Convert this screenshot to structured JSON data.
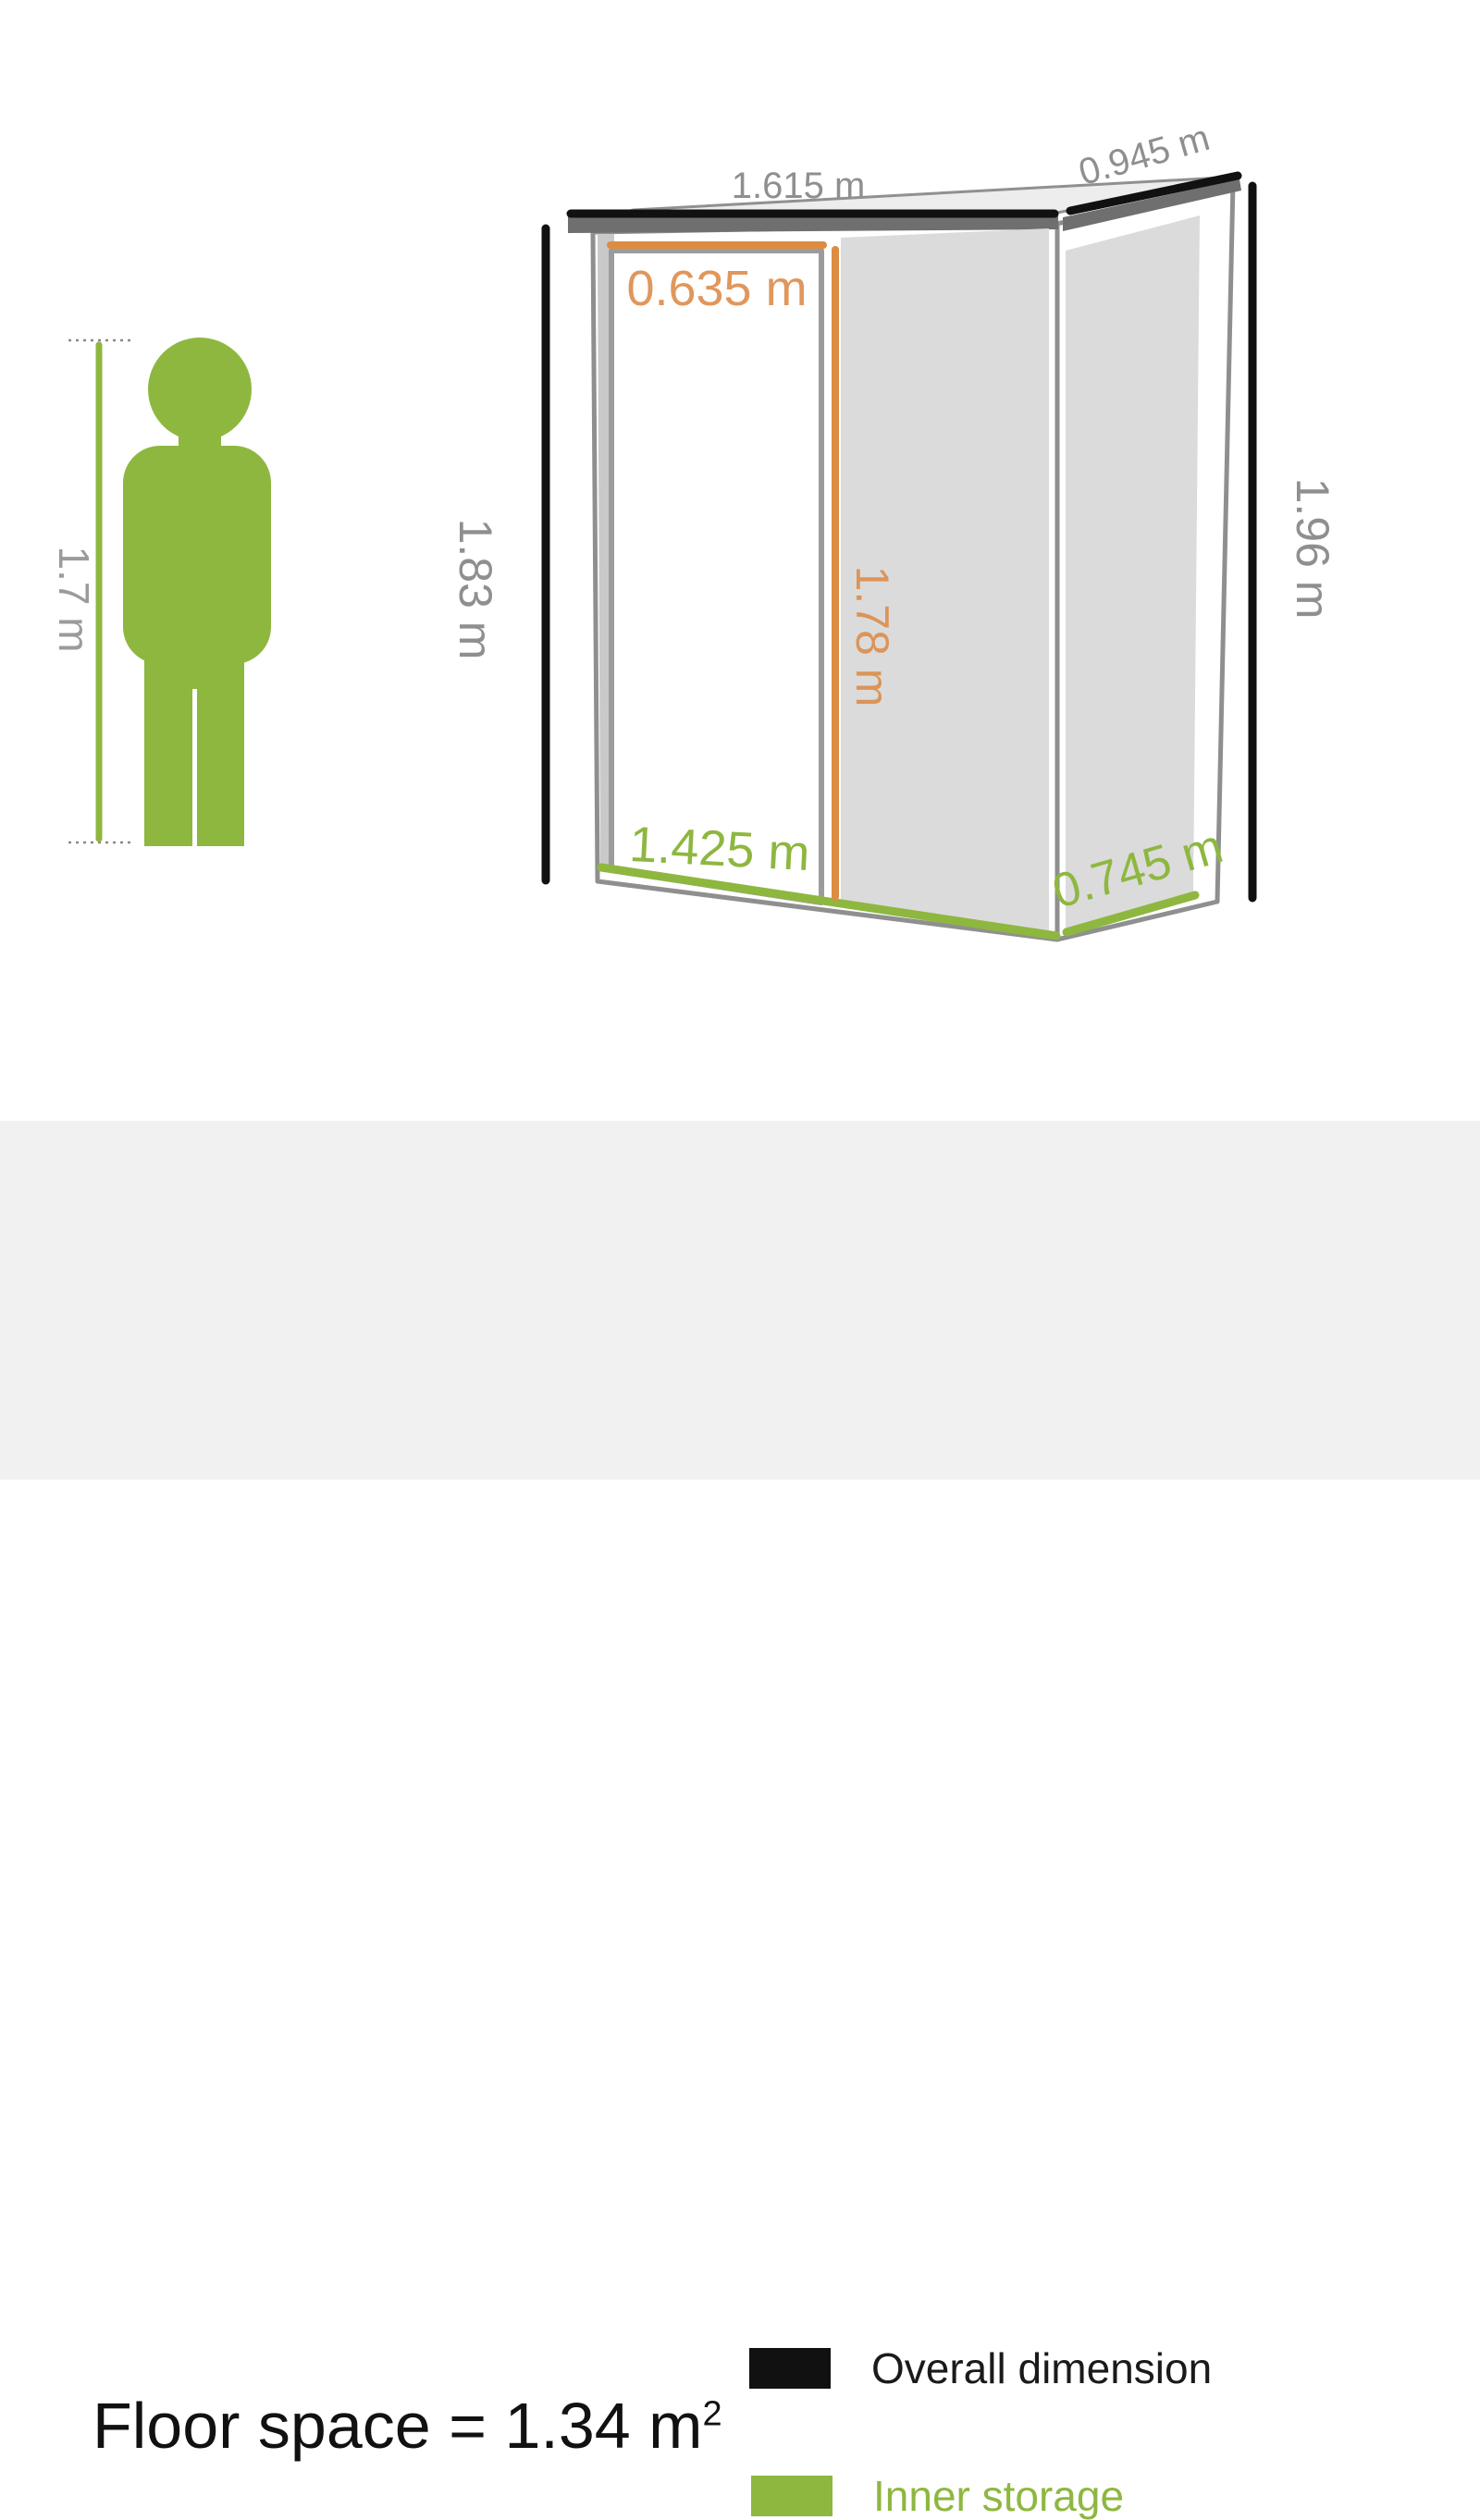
{
  "figure": {
    "person": {
      "height_label": "1.7 m"
    },
    "shed": {
      "labels": {
        "overall_width": "1.615 m",
        "overall_depth": "0.945 m",
        "front_height": "1.83 m",
        "overall_height": "1.96 m",
        "door_width": "0.635 m",
        "inner_height": "1.78 m",
        "inner_width": "1.425 m",
        "inner_depth": "0.745 m"
      }
    }
  },
  "footer": {
    "floor_space_text": "Floor space = 1.34 m",
    "floor_space_exponent": "2",
    "legend": [
      {
        "label": "Overall dimension",
        "swatch_color": "#111111"
      },
      {
        "label": "Inner storage",
        "swatch_color": "#8EB740"
      }
    ]
  },
  "colors": {
    "inner_green": "#8EB740",
    "door_orange": "#DD8C42",
    "orange_text": "#E0975C",
    "dimension_black": "#111111",
    "dimension_gray_text": "#8F8F8F",
    "wall_gray": "#DBDBDB",
    "door_jamb_gray": "#C9C9C9",
    "roof_gray": "#EDEDED",
    "fascia_gray": "#6F6F6F",
    "outline_gray": "#909090",
    "footer_background": "#F1F1F1"
  }
}
